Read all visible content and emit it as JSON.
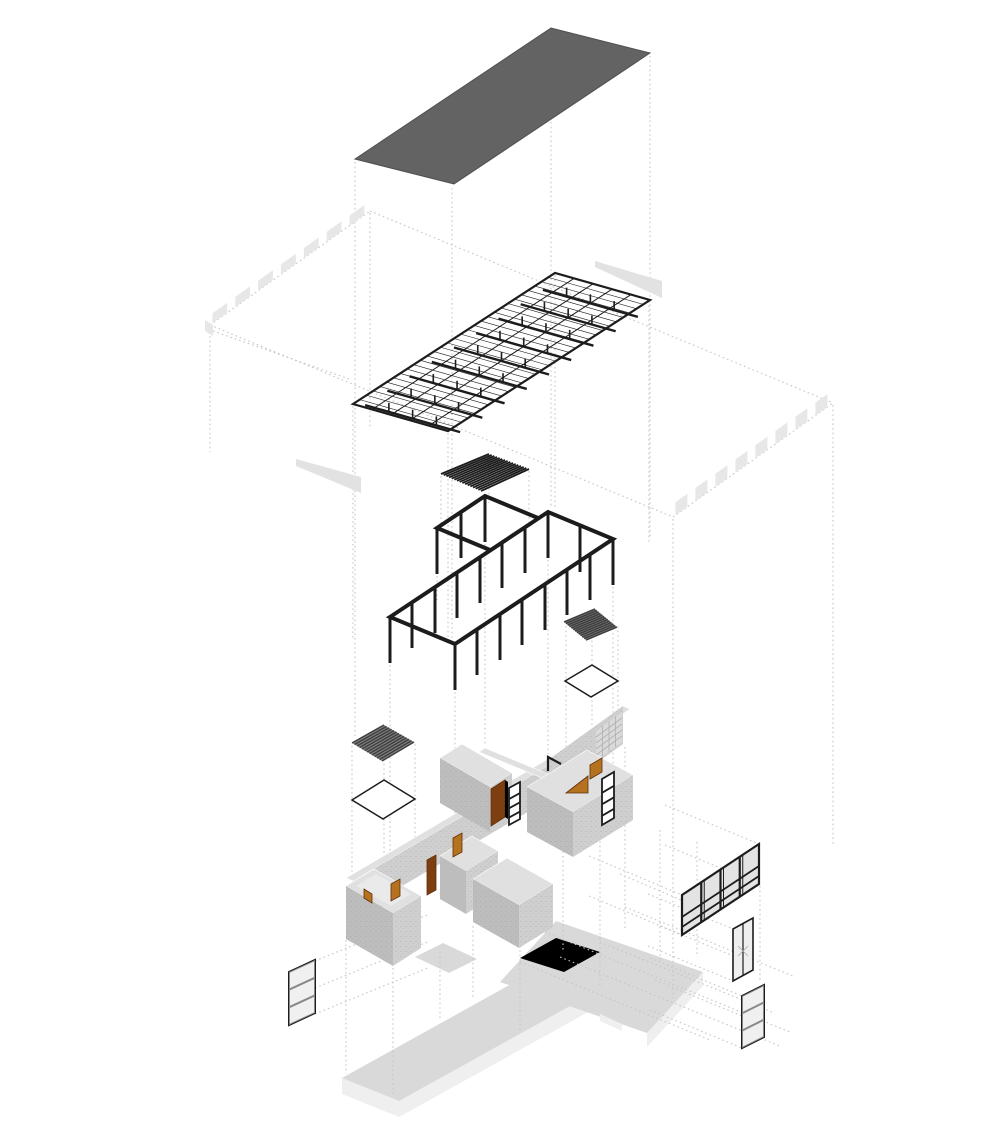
{
  "meta": {
    "title": "Exploded axonometric architectural diagram",
    "diagram_type": "exploded-axonometric",
    "projection": "dimetric",
    "background": "#ffffff",
    "has_text_labels": false
  },
  "palette": {
    "ink": "#1c1c1c",
    "roof": "#636363",
    "roofEdge": "#4f4f4f",
    "fascia": "#e7e7e7",
    "wedge": "#e2e2e2",
    "dotted": "#c5c5c5",
    "wallTop": "#e0e0e0",
    "wallSW": "#bdbdbd",
    "wallSE": "#cfcfcf",
    "wallLight": "#eaeaea",
    "doorBrown": "#7d3f10",
    "doorOrange": "#b5731f",
    "doorEdge": "#5f2f0a",
    "glass": "#e3e3e3",
    "glassLight": "#efefef",
    "louverDark": "#3f3f3f",
    "louverBg": "#858585",
    "slabTop": "#d9d9d9",
    "slabSide": "#efefef",
    "gridLine": "#b0b0b0",
    "stipple": "#8f8f8f"
  },
  "layers": [
    {
      "id": "roof-plane",
      "label": "roof plane",
      "color": "#636363"
    },
    {
      "id": "eaves-slab",
      "label": "eaves slab with segmented fascia and gutter wedges",
      "color": "#e7e7e7"
    },
    {
      "id": "roof-truss",
      "label": "steel roof truss and purlin grid",
      "color": "#1c1c1c"
    },
    {
      "id": "louver-upper",
      "label": "skylight louver grille (hatched)",
      "color": "#1c1c1c"
    },
    {
      "id": "structural-frame",
      "label": "post and beam frame with annex bay",
      "color": "#1c1c1c"
    },
    {
      "id": "louver-east",
      "label": "dark louver grille over east opening",
      "color": "#3f3f3f"
    },
    {
      "id": "outline-east",
      "label": "east roof opening outline",
      "color": "#1c1c1c"
    },
    {
      "id": "louver-west",
      "label": "dark louver grille over west opening",
      "color": "#3f3f3f"
    },
    {
      "id": "outline-west",
      "label": "west roof opening outline",
      "color": "#1c1c1c"
    },
    {
      "id": "masonry-walls",
      "label": "masonry wall enclosure with doors, ladder windows, glass block",
      "color": "#bdbdbd"
    },
    {
      "id": "glazing-panels",
      "label": "curtain wall, glazed door and stacked windows",
      "color": "#e3e3e3"
    },
    {
      "id": "floor-slab",
      "label": "cruciform ground floor slab",
      "color": "#d9d9d9"
    }
  ],
  "geometry": {
    "truss": {
      "purlin_lines": 30,
      "long_lines": 4,
      "chords": 9,
      "posts_per_chord": 3,
      "chord_drop": 9
    },
    "louvers": {
      "upper_slats": 15,
      "east_slats": 12,
      "west_slats": 12
    },
    "frame": {
      "columns": 20,
      "column_height": 46
    },
    "fascia": {
      "nw_segments": 7,
      "se_segments": 8
    },
    "curtain_wall": {
      "bays": 4,
      "rails_per_bay": 2
    },
    "stacked_windows": {
      "panes": 3
    },
    "glazed_door": {
      "panes": 2
    },
    "glass_block": {
      "cols": 4,
      "rows": 5
    },
    "doors": {
      "brown": 2,
      "orange": 4
    }
  }
}
